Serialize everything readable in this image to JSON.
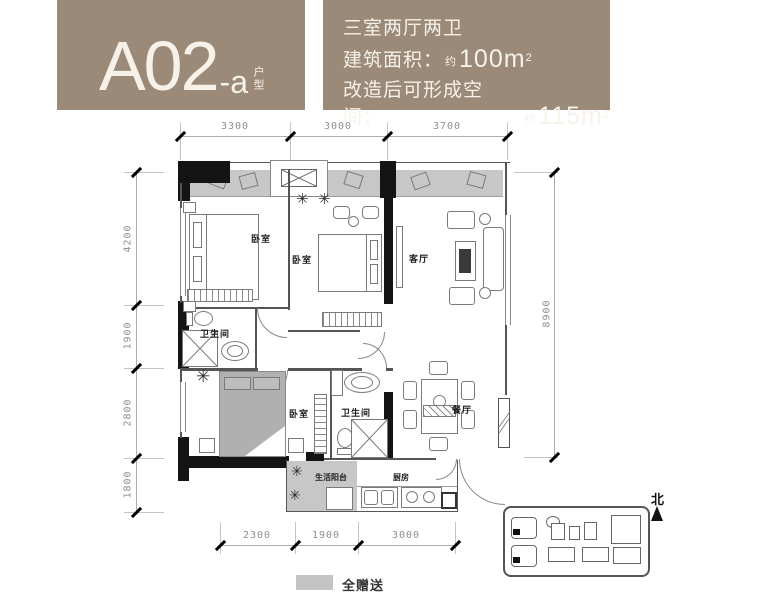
{
  "header": {
    "bg_color": "#9a8a77",
    "unit_code": "A02",
    "unit_variant": "-a",
    "unit_type_label": "户型",
    "spec_line1": "三室两厅两卫",
    "area_label": "建筑面积：",
    "area_approx": "约",
    "area_value": "100m",
    "area_sup": "2",
    "renov_label": "改造后可形成空间：",
    "renov_approx": "约",
    "renov_value": "115m",
    "renov_sup": "2"
  },
  "floorplan": {
    "rooms": {
      "bedroom_top_left": "卧室",
      "bedroom_middle": "卧室",
      "bedroom_bottom": "卧室",
      "living_room": "客厅",
      "dining_room": "餐厅",
      "bathroom_upper": "卫生间",
      "bathroom_lower": "卫生间",
      "kitchen": "厨房",
      "balcony": "生活阳台"
    },
    "dimensions": {
      "top": [
        "3300",
        "3000",
        "3700"
      ],
      "left": [
        "4200",
        "1900",
        "2800",
        "1800"
      ],
      "right": [
        "8900"
      ],
      "bottom": [
        "2300",
        "1900",
        "3000"
      ]
    },
    "colors": {
      "gifted_area": "#c7c7c7",
      "wall": "#141414"
    }
  },
  "legend": {
    "label": "全赠送",
    "swatch_color": "#c4c4c4"
  },
  "compass": {
    "label": "北"
  },
  "icons": {
    "plant": "✳"
  }
}
